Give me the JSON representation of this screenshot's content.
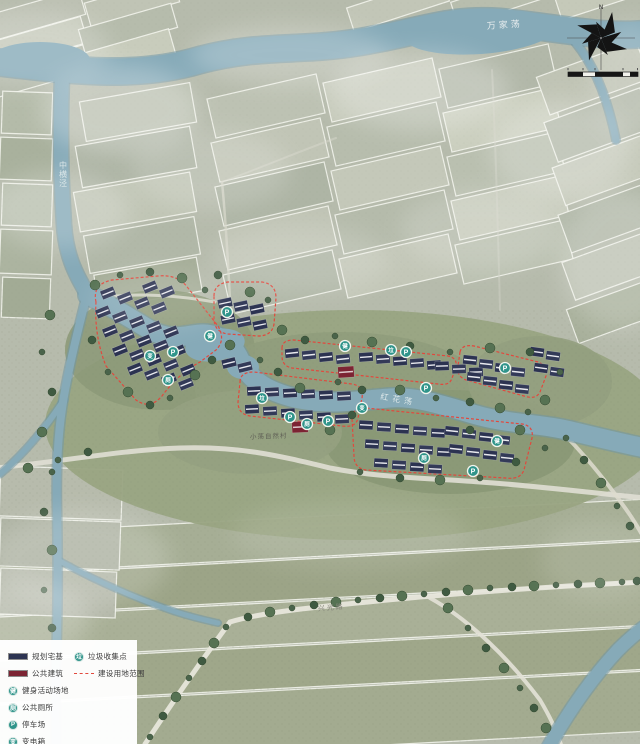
{
  "compass": {
    "north_label": "N"
  },
  "labels": [
    {
      "name": "river-label-wanjiadang",
      "text": "万家荡",
      "x": 487,
      "y": 29,
      "color": "#e7edee",
      "size": 9,
      "rot": -4,
      "spacing": 3,
      "vertical": false
    },
    {
      "name": "river-label-zhonghengjing",
      "text": "中横泾",
      "x": 63,
      "y": 168,
      "color": "#dce7e9",
      "size": 8,
      "rot": 0,
      "spacing": 0,
      "vertical": true
    },
    {
      "name": "river-label-honghuadang",
      "text": "红花荡",
      "x": 380,
      "y": 399,
      "color": "#dfe9ea",
      "size": 8,
      "rot": 10,
      "spacing": 4,
      "vertical": false
    },
    {
      "name": "road-label-xingguanglu",
      "text": "兴光路",
      "x": 318,
      "y": 611,
      "color": "#85857a",
      "size": 7,
      "rot": -5,
      "spacing": 2,
      "vertical": false
    },
    {
      "name": "site-label-village",
      "text": "小荡自然村",
      "x": 250,
      "y": 439,
      "color": "#5f5f55",
      "size": 6.5,
      "rot": -2,
      "spacing": 1,
      "vertical": false
    }
  ],
  "map_icons": [
    {
      "name": "parking-icon",
      "glyph": "P",
      "x": 173,
      "y": 352
    },
    {
      "name": "transformer-icon",
      "glyph": "变",
      "x": 150,
      "y": 356
    },
    {
      "name": "toilet-icon",
      "glyph": "厕",
      "x": 168,
      "y": 380
    },
    {
      "name": "fitness-icon",
      "glyph": "健",
      "x": 210,
      "y": 336
    },
    {
      "name": "parking-icon",
      "glyph": "P",
      "x": 227,
      "y": 312
    },
    {
      "name": "garbage-icon",
      "glyph": "垃",
      "x": 262,
      "y": 398
    },
    {
      "name": "parking-icon",
      "glyph": "P",
      "x": 290,
      "y": 417
    },
    {
      "name": "toilet-icon",
      "glyph": "厕",
      "x": 307,
      "y": 424
    },
    {
      "name": "parking-icon",
      "glyph": "P",
      "x": 328,
      "y": 421
    },
    {
      "name": "transformer-icon",
      "glyph": "变",
      "x": 362,
      "y": 408
    },
    {
      "name": "fitness-icon",
      "glyph": "健",
      "x": 345,
      "y": 346
    },
    {
      "name": "garbage-icon",
      "glyph": "垃",
      "x": 391,
      "y": 350
    },
    {
      "name": "parking-icon",
      "glyph": "P",
      "x": 406,
      "y": 352
    },
    {
      "name": "parking-icon",
      "glyph": "P",
      "x": 426,
      "y": 388
    },
    {
      "name": "parking-icon",
      "glyph": "P",
      "x": 505,
      "y": 368
    },
    {
      "name": "toilet-icon",
      "glyph": "厕",
      "x": 424,
      "y": 458
    },
    {
      "name": "fitness-icon",
      "glyph": "健",
      "x": 497,
      "y": 441
    },
    {
      "name": "parking-icon",
      "glyph": "P",
      "x": 473,
      "y": 471
    }
  ],
  "legend": {
    "left": [
      {
        "type": "swatch",
        "color_key": "homestead",
        "label": "规划宅基",
        "name": "legend-homestead"
      },
      {
        "type": "swatch",
        "color_key": "public_building",
        "label": "公共建筑",
        "name": "legend-public-building"
      },
      {
        "type": "icon",
        "glyph": "健",
        "label": "健身活动场地",
        "name": "legend-fitness"
      },
      {
        "type": "icon",
        "glyph": "厕",
        "label": "公共厕所",
        "name": "legend-toilet"
      },
      {
        "type": "icon",
        "glyph": "P",
        "label": "停车场",
        "name": "legend-parking"
      },
      {
        "type": "icon",
        "glyph": "变",
        "label": "变电箱",
        "name": "legend-transformer"
      }
    ],
    "right": [
      {
        "type": "icon",
        "glyph": "垃",
        "label": "垃圾收集点",
        "name": "legend-garbage"
      },
      {
        "type": "dashed",
        "label": "建设用地范围",
        "name": "legend-boundary"
      }
    ]
  },
  "colors": {
    "homestead": "#2c3351",
    "public_building": "#7c2433",
    "boundary": "#e2483d",
    "icon": "#2f948a",
    "water": "#86aab8"
  }
}
